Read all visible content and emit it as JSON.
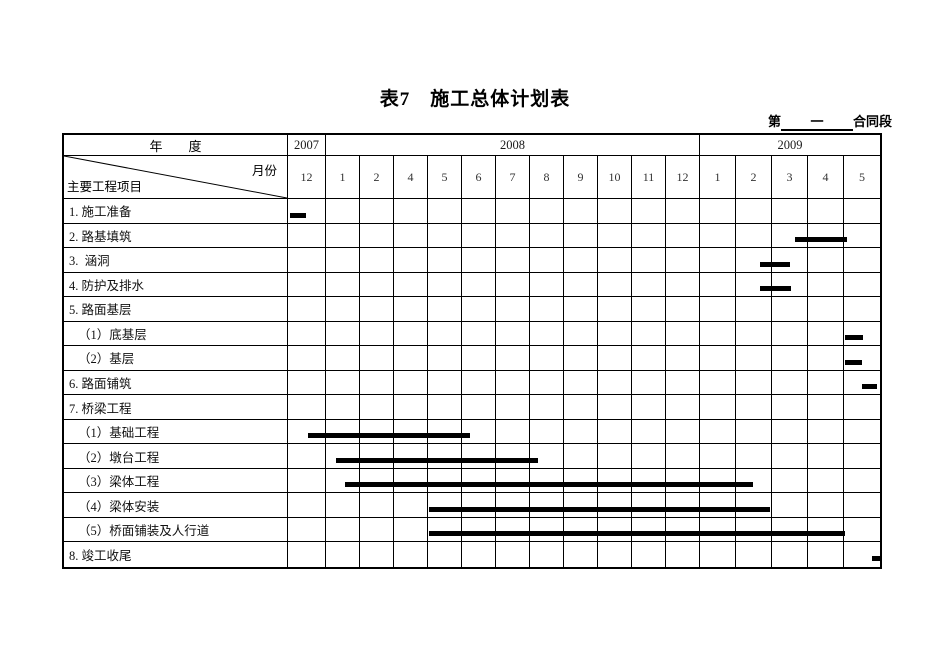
{
  "page": {
    "title": "表7　施工总体计划表",
    "contract": {
      "prefix": "第",
      "blank_text": "一",
      "suffix": "合同段"
    }
  },
  "table": {
    "year_axis_label": "年　　度",
    "month_axis_label": "月份",
    "items_axis_label": "主要工程项目",
    "years": [
      {
        "label": "2007",
        "cols": 1
      },
      {
        "label": "2008",
        "cols": 11
      },
      {
        "label": "2009",
        "cols": 5
      }
    ],
    "months": [
      "12",
      "1",
      "2",
      "4",
      "5",
      "6",
      "7",
      "8",
      "9",
      "10",
      "11",
      "12",
      "1",
      "2",
      "3",
      "4",
      "5"
    ],
    "rows": [
      {
        "label": "1. 施工准备",
        "indent": 0,
        "bar": {
          "start": 0.06,
          "end": 0.48
        }
      },
      {
        "label": "2. 路基填筑",
        "indent": 0,
        "bar": {
          "start": 14.64,
          "end": 16.08
        }
      },
      {
        "label": "3.  涵洞",
        "indent": 0,
        "bar": {
          "start": 13.67,
          "end": 14.5
        }
      },
      {
        "label": "4. 防护及排水",
        "indent": 0,
        "bar": {
          "start": 13.67,
          "end": 14.53
        }
      },
      {
        "label": "5. 路面基层",
        "indent": 0,
        "bar": null
      },
      {
        "label": "（1）底基层",
        "indent": 1,
        "bar": {
          "start": 16.03,
          "end": 16.54
        }
      },
      {
        "label": "（2）基层",
        "indent": 1,
        "bar": {
          "start": 16.03,
          "end": 16.51
        }
      },
      {
        "label": "6. 路面铺筑",
        "indent": 0,
        "bar": {
          "start": 16.51,
          "end": 16.91
        }
      },
      {
        "label": "7. 桥梁工程",
        "indent": 0,
        "bar": null
      },
      {
        "label": "（1）基础工程",
        "indent": 1,
        "bar": {
          "start": 0.53,
          "end": 5.24
        }
      },
      {
        "label": "（2）墩台工程",
        "indent": 1,
        "bar": {
          "start": 1.29,
          "end": 7.24
        }
      },
      {
        "label": "（3）梁体工程",
        "indent": 1,
        "bar": {
          "start": 1.56,
          "end": 13.47
        }
      },
      {
        "label": "（4）梁体安装",
        "indent": 1,
        "bar": {
          "start": 4.03,
          "end": 13.94
        }
      },
      {
        "label": "（5）桥面铺装及人行道",
        "indent": 1,
        "bar": {
          "start": 4.03,
          "end": 16.03
        }
      },
      {
        "label": "8. 竣工收尾",
        "indent": 0,
        "bar": {
          "start": 16.77,
          "end": 17.0
        }
      }
    ]
  },
  "chart_data": {
    "type": "gantt",
    "title": "表7　施工总体计划表",
    "x_unit": "timeline column position: 0 = left edge of 2007-12 column, 17 = right edge of 2009-05 column",
    "timeline": [
      {
        "year": "2007",
        "months": [
          "12"
        ]
      },
      {
        "year": "2008",
        "months": [
          "1",
          "2",
          "4",
          "5",
          "6",
          "7",
          "8",
          "9",
          "10",
          "11",
          "12"
        ]
      },
      {
        "year": "2009",
        "months": [
          "1",
          "2",
          "3",
          "4",
          "5"
        ]
      }
    ],
    "tasks": [
      {
        "name": "施工准备",
        "start": 0.06,
        "end": 0.48
      },
      {
        "name": "路基填筑",
        "start": 14.64,
        "end": 16.08
      },
      {
        "name": "涵洞",
        "start": 13.67,
        "end": 14.5
      },
      {
        "name": "防护及排水",
        "start": 13.67,
        "end": 14.53
      },
      {
        "name": "底基层",
        "start": 16.03,
        "end": 16.54
      },
      {
        "name": "基层",
        "start": 16.03,
        "end": 16.51
      },
      {
        "name": "路面铺筑",
        "start": 16.51,
        "end": 16.91
      },
      {
        "name": "基础工程",
        "start": 0.53,
        "end": 5.24
      },
      {
        "name": "墩台工程",
        "start": 1.29,
        "end": 7.24
      },
      {
        "name": "梁体工程",
        "start": 1.56,
        "end": 13.47
      },
      {
        "name": "梁体安装",
        "start": 4.03,
        "end": 13.94
      },
      {
        "name": "桥面铺装及人行道",
        "start": 4.03,
        "end": 16.03
      },
      {
        "name": "竣工收尾",
        "start": 16.77,
        "end": 17.0
      }
    ],
    "bar_color": "#000000"
  },
  "colors": {
    "line": "#000000",
    "bar": "#000000",
    "text": "#000000",
    "background": "#ffffff"
  }
}
